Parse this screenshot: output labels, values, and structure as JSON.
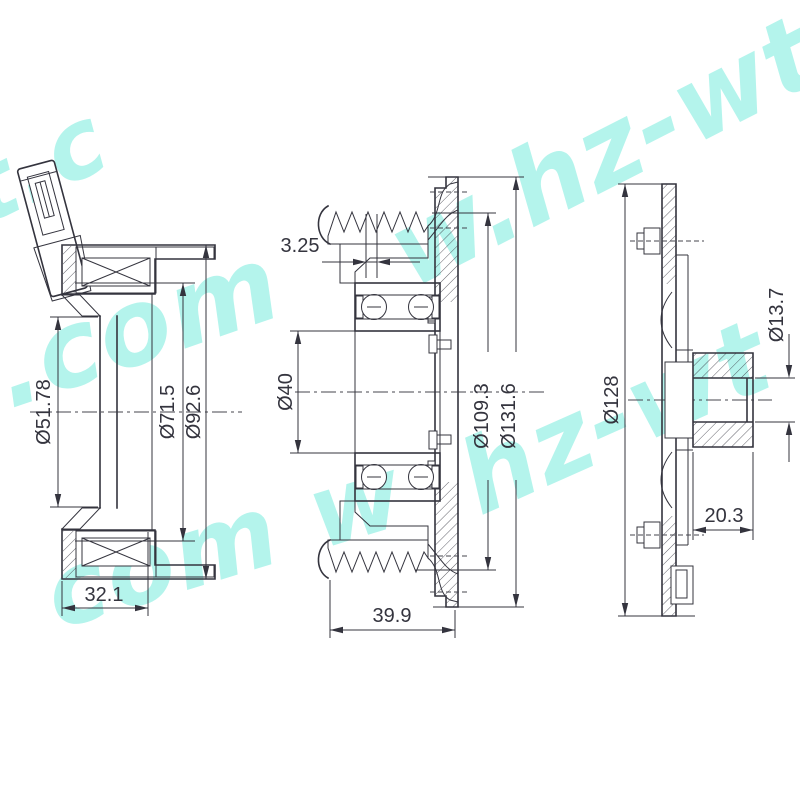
{
  "watermark": {
    "text": "www.hz-wt.com",
    "color": "#6fe9db",
    "fragments": {
      "f0": "t.c",
      "f1": "t.com",
      "f2": "com w",
      "f3": "w.hz-wt.",
      "f4": "hz-wt"
    }
  },
  "drawing": {
    "line_color": "#34343e",
    "views": {
      "coil_housing": {
        "dims": {
          "bore": "Ø51.78",
          "coil": "Ø71.5",
          "outer": "Ø92.6",
          "depth": "32.1"
        }
      },
      "pulley": {
        "dims": {
          "groove": "3.25",
          "bore": "Ø40",
          "face": "Ø109.3",
          "outer": "Ø131.6",
          "width": "39.9"
        }
      },
      "hub": {
        "dims": {
          "outer": "Ø128",
          "shaft": "Ø13.7",
          "boss": "20.3"
        }
      }
    }
  }
}
